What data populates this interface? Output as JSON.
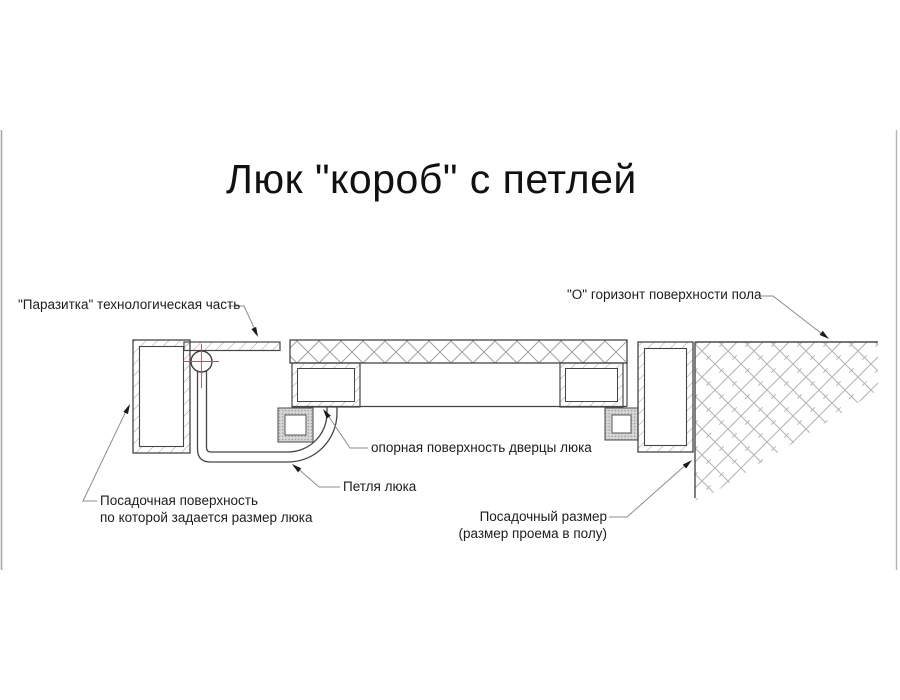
{
  "title": "Люк \"короб\" с петлей",
  "labels": {
    "parasitka": "\"Паразитка\" технологическая часть",
    "floor_horizon": "\"О\" горизонт поверхности пола",
    "bearing_surface": "опорная поверхность дверцы люка",
    "hinge": "Петля люка",
    "seating_surface": {
      "line1": "Посадочная поверхность",
      "line2": "по которой задается размер люка"
    },
    "seating_size": {
      "line1": "Посадочный размер",
      "line2": "(размер проема в полу)"
    }
  },
  "colors": {
    "drawing_line": "#454545",
    "hatch_line": "#a0a0a0",
    "leader_line": "#8d8d8d",
    "arrowhead": "#1a1a1a",
    "center_mark_red": "#b05855",
    "text": "#1c1c1c",
    "background": "#ffffff"
  }
}
